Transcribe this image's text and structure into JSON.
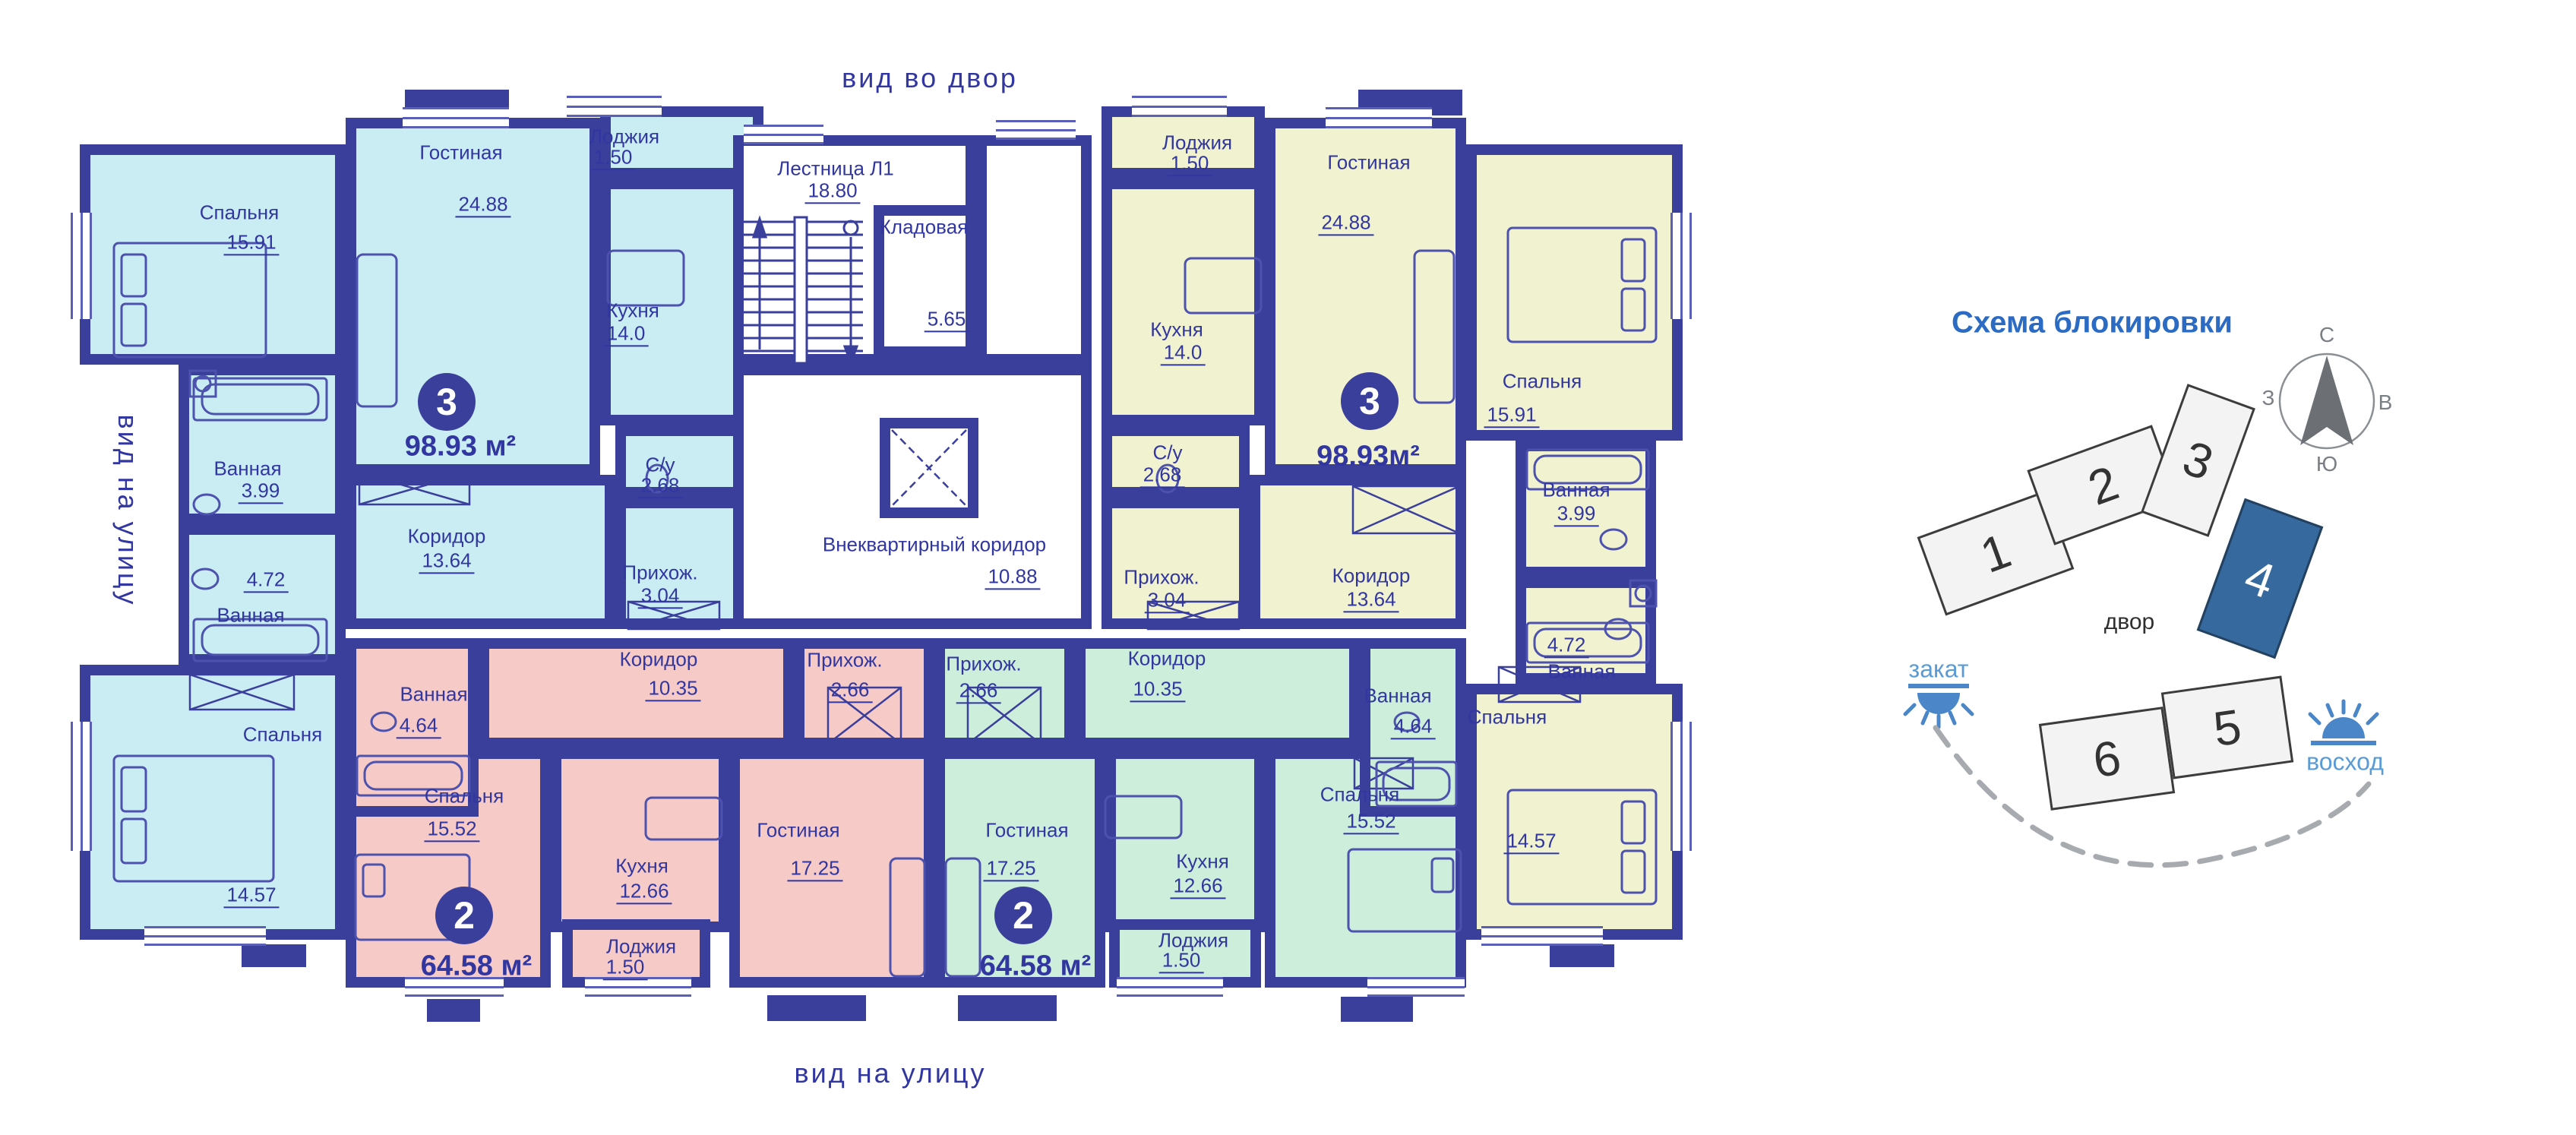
{
  "titles": {
    "top": "вид во двор",
    "bottom": "вид на улицу",
    "left": "вид на улицу"
  },
  "common": {
    "stairs": {
      "name": "Лестница Л1",
      "area": "18.80"
    },
    "storage": {
      "name": "Кладовая",
      "area": "5.65"
    },
    "corridor": {
      "name": "Внеквартирный коридор",
      "area": "10.88"
    }
  },
  "apartments": {
    "apt3_left": {
      "number": "3",
      "area_label": "98.93 м²",
      "rooms": {
        "bedroom_top": {
          "name": "Спальня",
          "area": "15.91"
        },
        "bath_top": {
          "name": "Ванная",
          "area": "3.99"
        },
        "bath_bottom": {
          "name": "Ванная",
          "area": "4.72"
        },
        "bedroom_bottom": {
          "name": "Спальня",
          "area": "14.57"
        },
        "living": {
          "name": "Гостиная",
          "area": "24.88"
        },
        "loggia": {
          "name": "Лоджия",
          "area": "1.50"
        },
        "kitchen": {
          "name": "Кухня",
          "area": "14.0"
        },
        "wc": {
          "name": "С/у",
          "area": "2.68"
        },
        "hallway": {
          "name": "Прихож.",
          "area": "3.04"
        },
        "corridor": {
          "name": "Коридор",
          "area": "13.64"
        }
      }
    },
    "apt3_right": {
      "number": "3",
      "area_label": "98.93м²",
      "rooms": {
        "bedroom_top": {
          "name": "Спальня",
          "area": "15.91"
        },
        "bath_top": {
          "name": "Ванная",
          "area": "3.99"
        },
        "bath_bottom": {
          "name": "Ванная",
          "area": "4.72"
        },
        "bedroom_bottom": {
          "name": "Спальня",
          "area": "14.57"
        },
        "living": {
          "name": "Гостиная",
          "area": "24.88"
        },
        "loggia": {
          "name": "Лоджия",
          "area": "1.50"
        },
        "kitchen": {
          "name": "Кухня",
          "area": "14.0"
        },
        "wc": {
          "name": "С/у",
          "area": "2.68"
        },
        "hallway": {
          "name": "Прихож.",
          "area": "3.04"
        },
        "corridor": {
          "name": "Коридор",
          "area": "13.64"
        }
      }
    },
    "apt2_left": {
      "number": "2",
      "area_label": "64.58 м²",
      "rooms": {
        "bath": {
          "name": "Ванная",
          "area": "4.64"
        },
        "corridor": {
          "name": "Коридор",
          "area": "10.35"
        },
        "hallway": {
          "name": "Прихож.",
          "area": "2.66"
        },
        "bedroom": {
          "name": "Спальня",
          "area": "15.52"
        },
        "kitchen": {
          "name": "Кухня",
          "area": "12.66"
        },
        "living": {
          "name": "Гостиная",
          "area": "17.25"
        },
        "loggia": {
          "name": "Лоджия",
          "area": "1.50"
        }
      }
    },
    "apt2_right": {
      "number": "2",
      "area_label": "64.58 м²",
      "rooms": {
        "bath": {
          "name": "Ванная",
          "area": "4.64"
        },
        "corridor": {
          "name": "Коридор",
          "area": "10.35"
        },
        "hallway": {
          "name": "Прихож.",
          "area": "2.66"
        },
        "bedroom": {
          "name": "Спальня",
          "area": "15.52"
        },
        "kitchen": {
          "name": "Кухня",
          "area": "12.66"
        },
        "living": {
          "name": "Гостиная",
          "area": "17.25"
        },
        "loggia": {
          "name": "Лоджия",
          "area": "1.50"
        }
      }
    }
  },
  "schema": {
    "title": "Схема блокировки",
    "blocks": [
      "1",
      "2",
      "3",
      "4",
      "5",
      "6"
    ],
    "highlighted_block": "4",
    "courtyard": "двор",
    "sunset": "закат",
    "sunrise": "восход",
    "compass": {
      "north": "С",
      "south": "Ю",
      "west": "З",
      "east": "В"
    }
  },
  "colors": {
    "wall": "#3b3f9c",
    "ink": "#3136a0",
    "cyan": "#c9edf2",
    "yellow": "#f1f2cf",
    "pink": "#f6cac6",
    "green": "#cdeeda",
    "accent_blue": "#2b6bc4",
    "block_highlight": "#36699e",
    "sun_blue": "#4a86c8"
  }
}
